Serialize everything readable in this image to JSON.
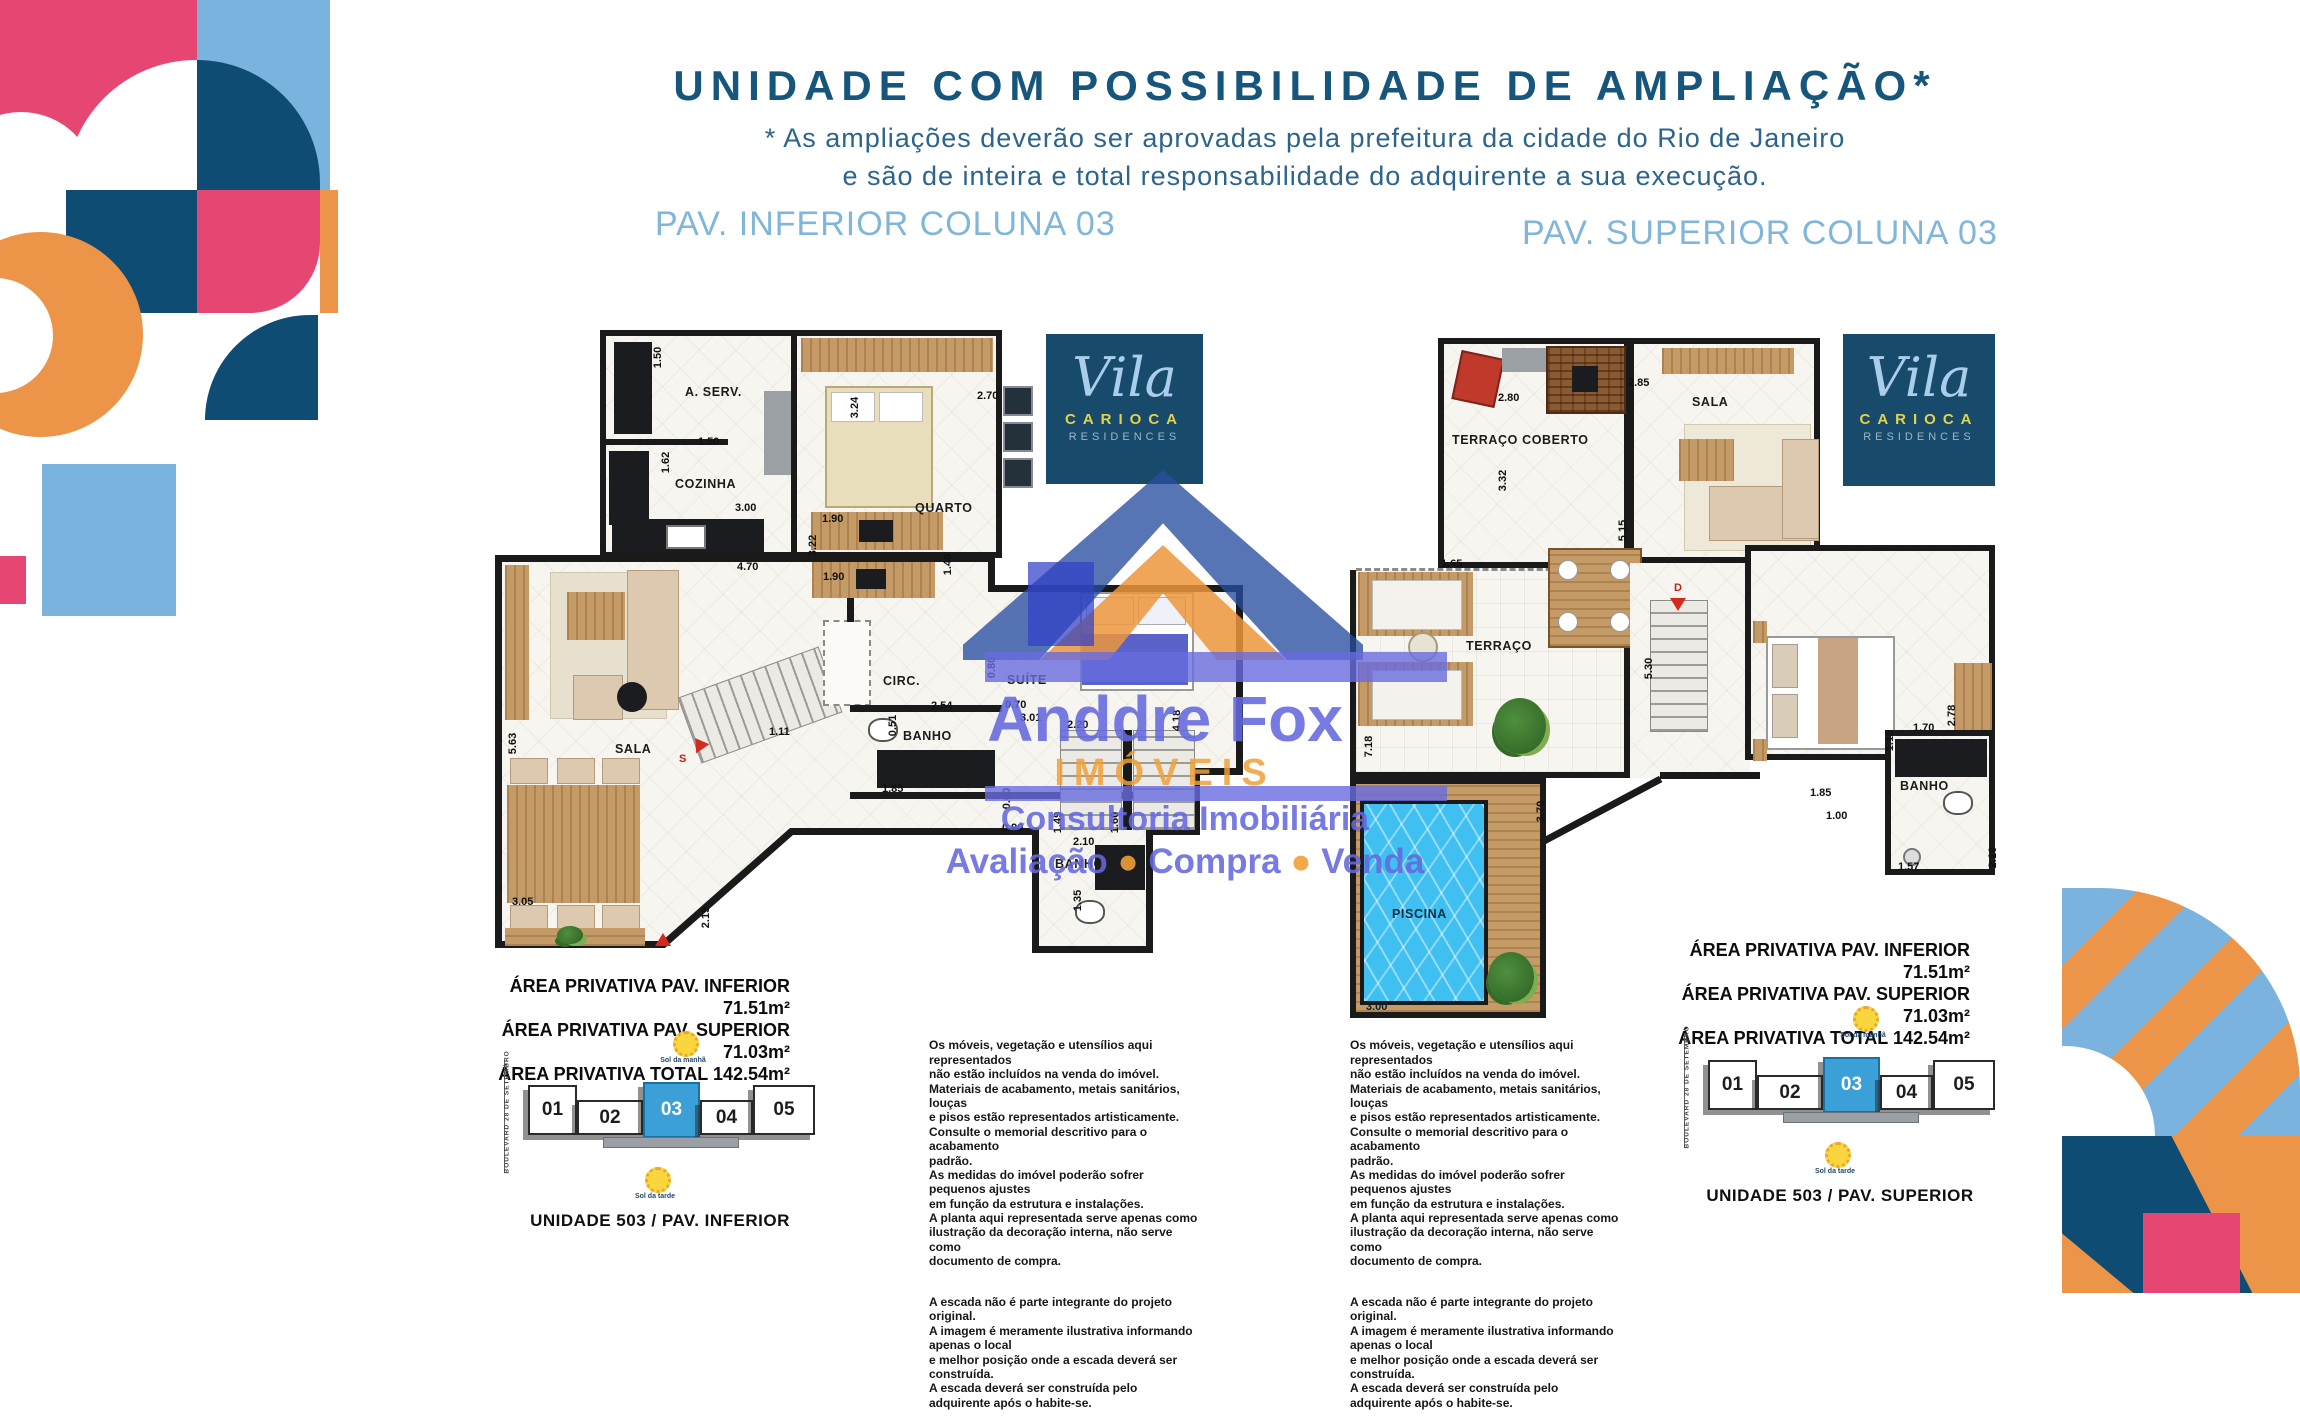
{
  "header": {
    "title": "UNIDADE COM POSSIBILIDADE DE AMPLIAÇÃO*",
    "subtitle": "* As ampliações deverão ser aprovadas pela prefeitura da cidade do Rio de Janeiro\ne são de inteira e total responsabilidade do adquirente  a sua execução."
  },
  "logo": {
    "script": "Vila",
    "name": "CARIOCA",
    "sub": "RESIDENCES"
  },
  "watermark": {
    "brand": "Anddre Fox",
    "line2": "IMÓVEIS",
    "line3": "Consultoria Imobiliária",
    "svc1": "Avaliação",
    "svc2": "Compra",
    "svc3": "Venda"
  },
  "plan_inferior": {
    "header": "PAV. INFERIOR COLUNA 03",
    "rooms": {
      "aserv": "A. SERV.",
      "cozinha": "COZINHA",
      "quarto": "QUARTO",
      "sala": "SALA",
      "circ": "CIRC.",
      "banho": "BANHO",
      "suite": "SUÍTE",
      "banho2": "BANHO"
    },
    "dims": [
      "1.50",
      "1.50",
      "1.62",
      "3.00",
      "4.70",
      "2.70",
      "3.24",
      "1.90",
      "3.22",
      "1.40",
      "1.90",
      "5.63",
      "3.05",
      "1.11",
      "2.15",
      "2.54",
      "0.51",
      "1.85",
      "0.70",
      "3.01",
      "2.20",
      "4.18",
      "0.80",
      "0.60",
      "0.90",
      "1.49",
      "1.60",
      "2.10",
      "1.35"
    ],
    "stair_marker": "S",
    "areas": "ÁREA PRIVATIVA PAV. INFERIOR 71.51m²\nÁREA PRIVATIVA PAV. SUPERIOR 71.03m²\nÁREA PRIVATIVA TOTAL 142.54m²"
  },
  "plan_superior": {
    "header": "PAV. SUPERIOR COLUNA 03",
    "rooms": {
      "terraco_coberto": "TERRAÇO COBERTO",
      "sala": "SALA",
      "terraco": "TERRAÇO",
      "piscina": "PISCINA",
      "banho": "BANHO"
    },
    "dims": [
      "2.80",
      "3.32",
      "2.85",
      "5.15",
      "1.65",
      "7.18",
      "5.30",
      "3.70",
      "3.00",
      "1.85",
      "1.00",
      "1.15",
      "1.70",
      "2.78",
      "1.57",
      "2.10"
    ],
    "stair_marker": "D",
    "areas": "ÁREA PRIVATIVA PAV. INFERIOR 71.51m²\nÁREA PRIVATIVA PAV. SUPERIOR 71.03m²\nÁREA PRIVATIVA TOTAL 142.54m²"
  },
  "locator_inferior": {
    "units": [
      "01",
      "02",
      "03",
      "04",
      "05"
    ],
    "highlight": "03",
    "sun_top": "Sol da manhã",
    "sun_bottom": "Sol da tarde",
    "street": "BOULEVARD 28 DE SETEMBRO",
    "caption": "UNIDADE 503 / PAV. INFERIOR"
  },
  "locator_superior": {
    "units": [
      "01",
      "02",
      "03",
      "04",
      "05"
    ],
    "highlight": "03",
    "sun_top": "Sol da manhã",
    "sun_bottom": "Sol da tarde",
    "street": "BOULEVARD 28 DE SETEMBRO",
    "caption": "UNIDADE 503 / PAV. SUPERIOR"
  },
  "disclaimer": {
    "p1": "Os móveis, vegetação e utensílios aqui representados\nnão estão incluídos na venda do imóvel.\nMateriais de acabamento, metais sanitários, louças\ne pisos estão representados artisticamente.\nConsulte o memorial descritivo para o acabamento\npadrão.\nAs medidas do imóvel poderão sofrer pequenos ajustes\nem função da estrutura e instalações.\nA planta aqui representada serve apenas como\nilustração da decoração interna, não serve como\ndocumento de compra.",
    "p2": "A escada não é parte integrante do projeto original.\nA imagem é meramente ilustrativa informando apenas o local\ne melhor posição onde a escada deverá ser construída.\nA escada deverá ser construída pelo adquirente após o habite-se."
  },
  "colors": {
    "brand_navy": "#0f4c74",
    "brand_pink": "#e64672",
    "brand_lightblue": "#7ab3de",
    "brand_orange": "#ec9447",
    "header_blue": "#80b6da",
    "title_navy": "#17567c",
    "watermark_periwinkle": "#6468dd",
    "watermark_orange": "#f0a037",
    "pool_blue": "#3fc0f0",
    "locator_highlight": "#3ba0d8"
  }
}
